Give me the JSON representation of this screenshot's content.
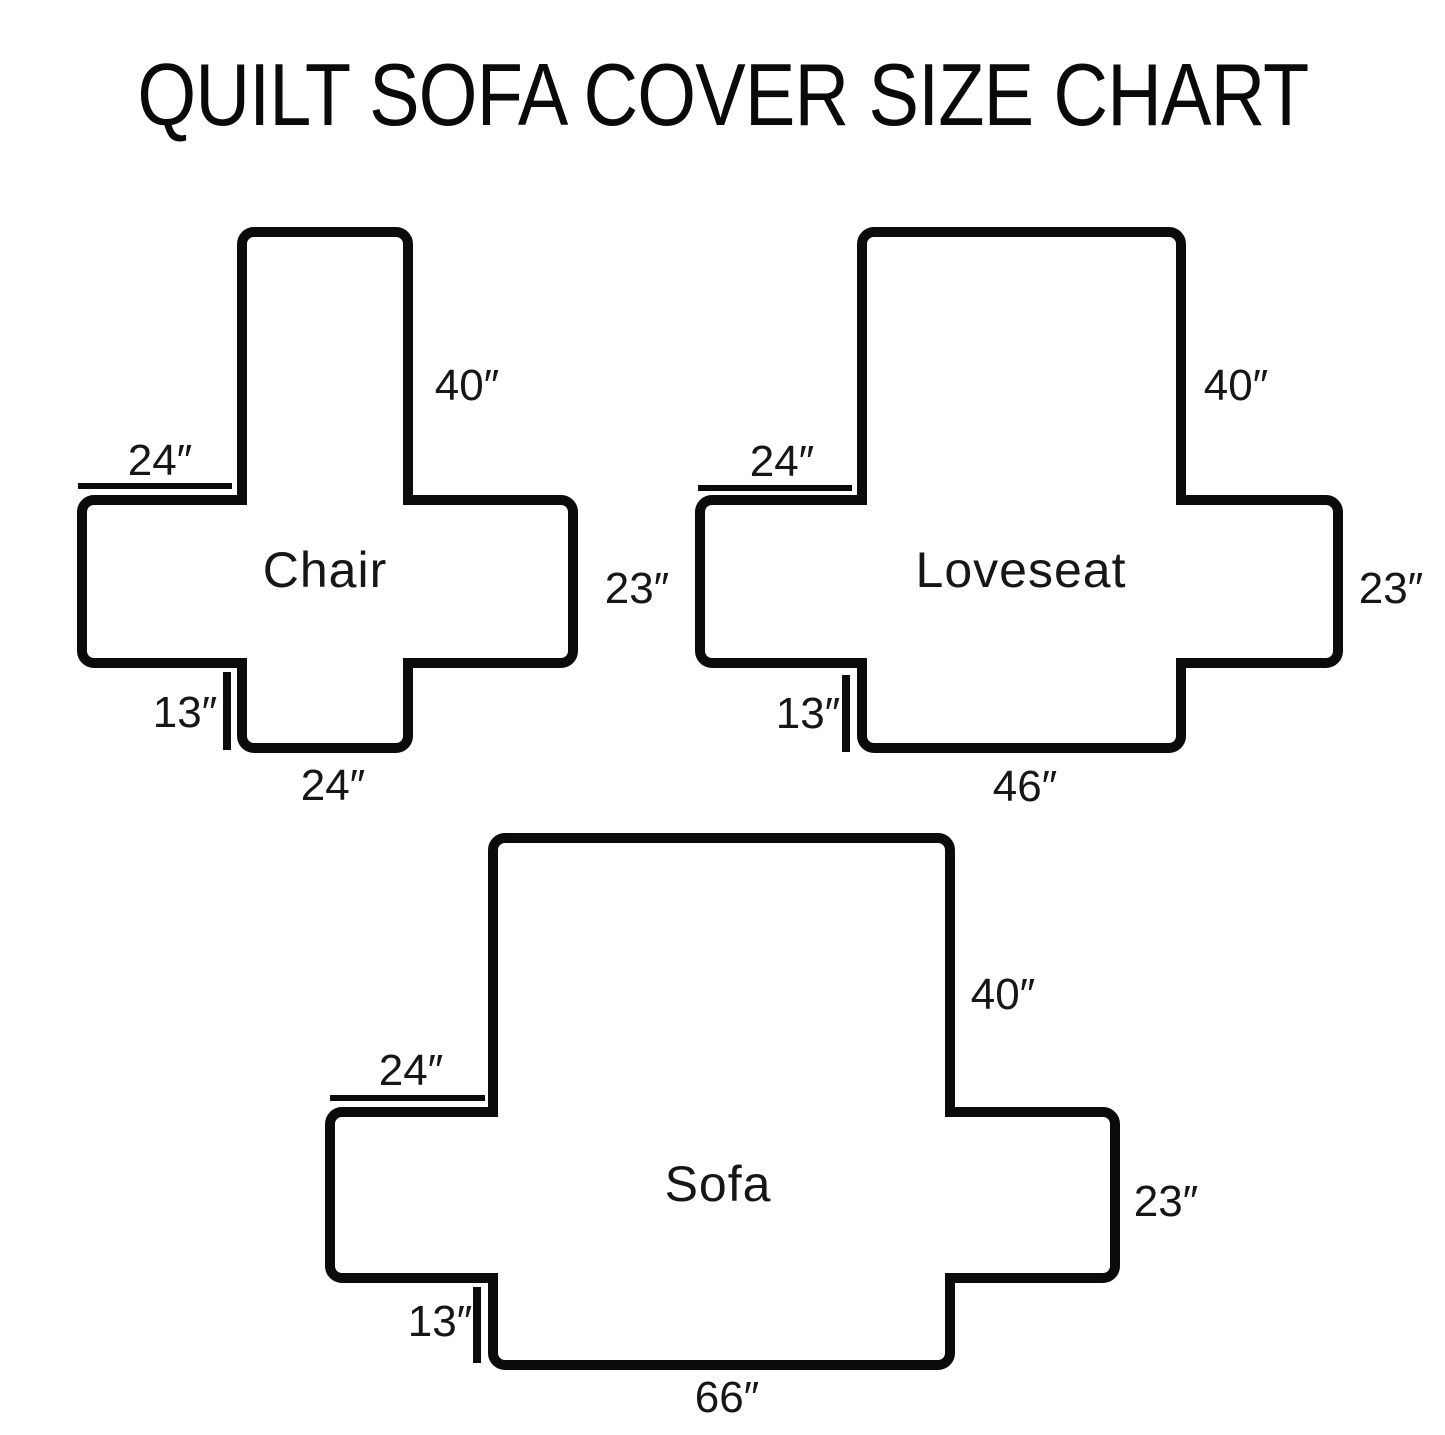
{
  "title": "QUILT SOFA COVER SIZE CHART",
  "colors": {
    "line": "#000000",
    "background": "#ffffff",
    "text": "#161616"
  },
  "diagrams": [
    {
      "name": "Chair",
      "back_height": "40″",
      "arm_top_width": "24″",
      "arm_side_height": "23″",
      "front_skirt_drop": "13″",
      "seat_bottom_width": "24″"
    },
    {
      "name": "Loveseat",
      "back_height": "40″",
      "arm_top_width": "24″",
      "arm_side_height": "23″",
      "front_skirt_drop": "13″",
      "seat_bottom_width": "46″"
    },
    {
      "name": "Sofa",
      "back_height": "40″",
      "arm_top_width": "24″",
      "arm_side_height": "23″",
      "front_skirt_drop": "13″",
      "seat_bottom_width": "66″"
    }
  ]
}
